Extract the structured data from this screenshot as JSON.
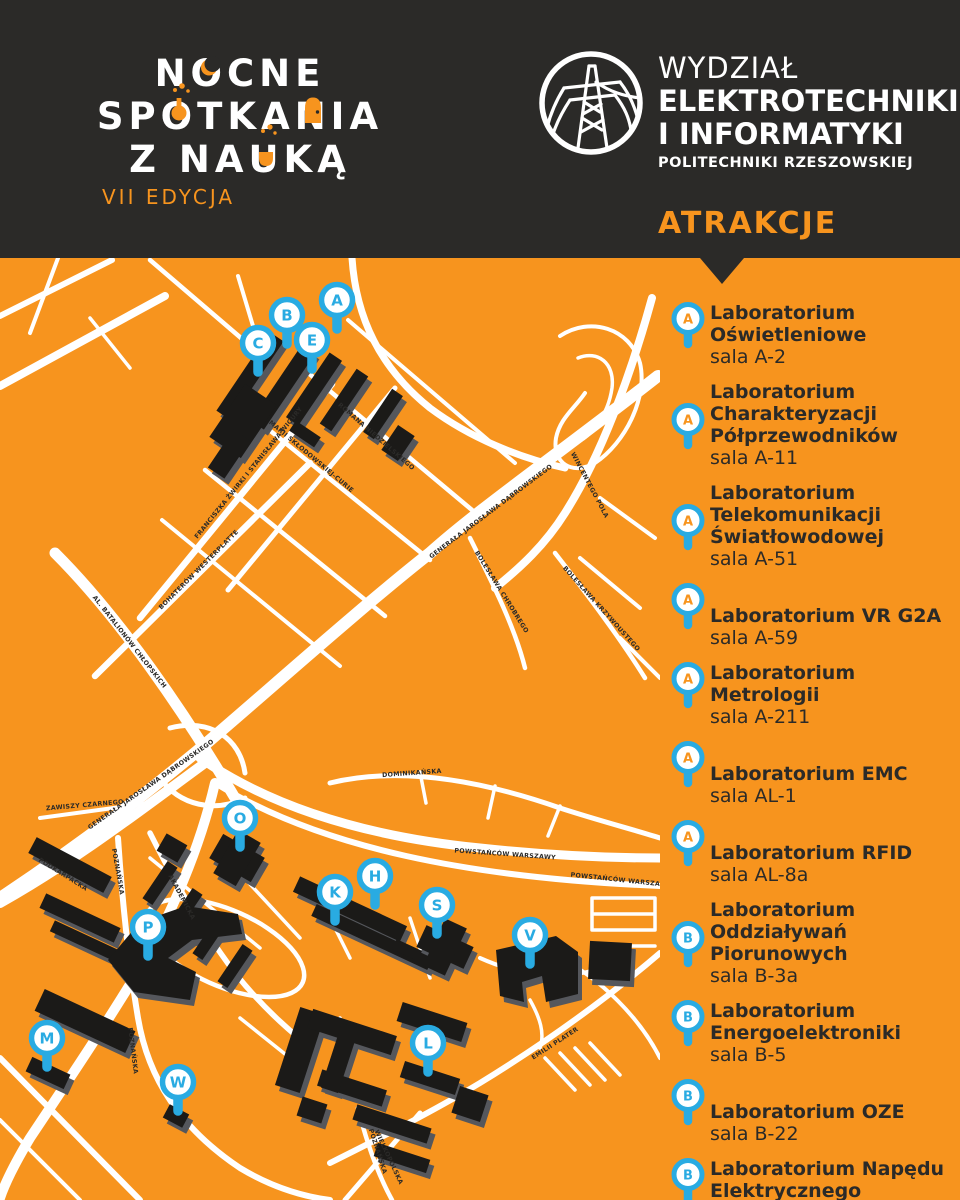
{
  "colors": {
    "orange": "#F7941E",
    "dark": "#2B2A28",
    "blue": "#29ABE2",
    "white": "#FFFFFF",
    "building": "#1B1A18",
    "building_side": "#55575C"
  },
  "header": {
    "brand": {
      "line1": "NOCNE",
      "line2": "SPOTKANIA",
      "line3": "Z NAUKĄ",
      "edition": "VII EDYCJA"
    },
    "faculty": {
      "line1": "WYDZIAŁ",
      "line2": "ELEKTROTECHNIKI",
      "line3": "I INFORMATYKI",
      "line4": "POLITECHNIKI RZESZOWSKIEJ",
      "logo": "power-pylon-in-circle"
    },
    "section_title": "ATRAKCJE"
  },
  "map": {
    "markers": [
      {
        "letter": "A",
        "x": 337,
        "y": 42
      },
      {
        "letter": "B",
        "x": 287,
        "y": 57
      },
      {
        "letter": "C",
        "x": 258,
        "y": 85
      },
      {
        "letter": "E",
        "x": 312,
        "y": 82
      },
      {
        "letter": "O",
        "x": 240,
        "y": 560
      },
      {
        "letter": "P",
        "x": 148,
        "y": 669
      },
      {
        "letter": "K",
        "x": 335,
        "y": 634
      },
      {
        "letter": "H",
        "x": 375,
        "y": 618
      },
      {
        "letter": "S",
        "x": 437,
        "y": 647
      },
      {
        "letter": "V",
        "x": 530,
        "y": 677
      },
      {
        "letter": "M",
        "x": 47,
        "y": 780
      },
      {
        "letter": "W",
        "x": 178,
        "y": 824
      },
      {
        "letter": "L",
        "x": 428,
        "y": 785
      }
    ],
    "street_labels": [
      {
        "text": "FRANCISZKA ŻWIRKI I STANISŁAWA WIGURY",
        "x": 250,
        "y": 216,
        "rot": -51
      },
      {
        "text": "MARII SKŁODOWSKIEJ-CURIE",
        "x": 310,
        "y": 200,
        "rot": 40
      },
      {
        "text": "ROMANA NIEDZIELSKIEGO",
        "x": 375,
        "y": 180,
        "rot": 41
      },
      {
        "text": "BOHATERÓW WESTERPLATTE",
        "x": 200,
        "y": 313,
        "rot": -45
      },
      {
        "text": "AL. BATALIONÓW CHŁOPSKICH",
        "x": 128,
        "y": 385,
        "rot": 52
      },
      {
        "text": "GENERAŁA JAROSŁAWA DĄBROWSKIEGO",
        "x": 492,
        "y": 255,
        "rot": -37
      },
      {
        "text": "GENERAŁA JAROSŁAWA DĄBROWSKIEGO",
        "x": 152,
        "y": 528,
        "rot": -35
      },
      {
        "text": "WINCENTEGO POLA",
        "x": 588,
        "y": 228,
        "rot": 62
      },
      {
        "text": "BOLESŁAWA CHROBREGO",
        "x": 500,
        "y": 335,
        "rot": 58
      },
      {
        "text": "BOLESŁAWA KRZYWOUSTEGO",
        "x": 600,
        "y": 352,
        "rot": 48
      },
      {
        "text": "ZAWISZY CZARNEGO",
        "x": 85,
        "y": 549,
        "rot": -5
      },
      {
        "text": "PODKARPACKA",
        "x": 62,
        "y": 618,
        "rot": 32
      },
      {
        "text": "POZNAŃSKA",
        "x": 116,
        "y": 614,
        "rot": 80
      },
      {
        "text": "POZNAŃSKA",
        "x": 131,
        "y": 793,
        "rot": 83
      },
      {
        "text": "POZNAŃSKA",
        "x": 376,
        "y": 894,
        "rot": 72
      },
      {
        "text": "AKADEMICKA",
        "x": 180,
        "y": 640,
        "rot": 62
      },
      {
        "text": "POWSTAŃCÓW WARSZAWY",
        "x": 505,
        "y": 598,
        "rot": 4
      },
      {
        "text": "POWSTAŃCÓW WARSZAWY",
        "x": 621,
        "y": 624,
        "rot": 6
      },
      {
        "text": "EMILII PLATER",
        "x": 556,
        "y": 787,
        "rot": -33
      },
      {
        "text": "WIELKOPOLSKA",
        "x": 387,
        "y": 900,
        "rot": 65
      },
      {
        "text": "DOMINIKAŃSKA",
        "x": 412,
        "y": 517,
        "rot": -4
      }
    ]
  },
  "attractions": [
    {
      "marker": "A",
      "marker_color": "orange",
      "title": "Laboratorium Oświetleniowe",
      "room": "sala A-2"
    },
    {
      "marker": "A",
      "marker_color": "orange",
      "title": "Laboratorium Charakteryzacji Półprzewodników",
      "room": "sala A-11"
    },
    {
      "marker": "A",
      "marker_color": "orange",
      "title": "Laboratorium Telekomunikacji Światłowodowej",
      "room": "sala A-51"
    },
    {
      "marker": "A",
      "marker_color": "orange",
      "title": "Laboratorium VR G2A",
      "room": "sala A-59"
    },
    {
      "marker": "A",
      "marker_color": "orange",
      "title": "Laboratorium Metrologii",
      "room": "sala A-211"
    },
    {
      "marker": "A",
      "marker_color": "orange",
      "title": "Laboratorium EMC",
      "room": "sala AL-1"
    },
    {
      "marker": "A",
      "marker_color": "orange",
      "title": "Laboratorium RFID",
      "room": "sala AL-8a"
    },
    {
      "marker": "B",
      "marker_color": "blue",
      "title": "Laboratorium Oddziaływań Piorunowych",
      "room": "sala B-3a"
    },
    {
      "marker": "B",
      "marker_color": "blue",
      "title": "Laboratorium Energoelektroniki",
      "room": "sala B-5"
    },
    {
      "marker": "B",
      "marker_color": "blue",
      "title": "Laboratorium OZE",
      "room": "sala B-22"
    },
    {
      "marker": "B",
      "marker_color": "blue",
      "title": "Laboratorium Napędu Elektrycznego",
      "room": "sala B-50"
    }
  ]
}
